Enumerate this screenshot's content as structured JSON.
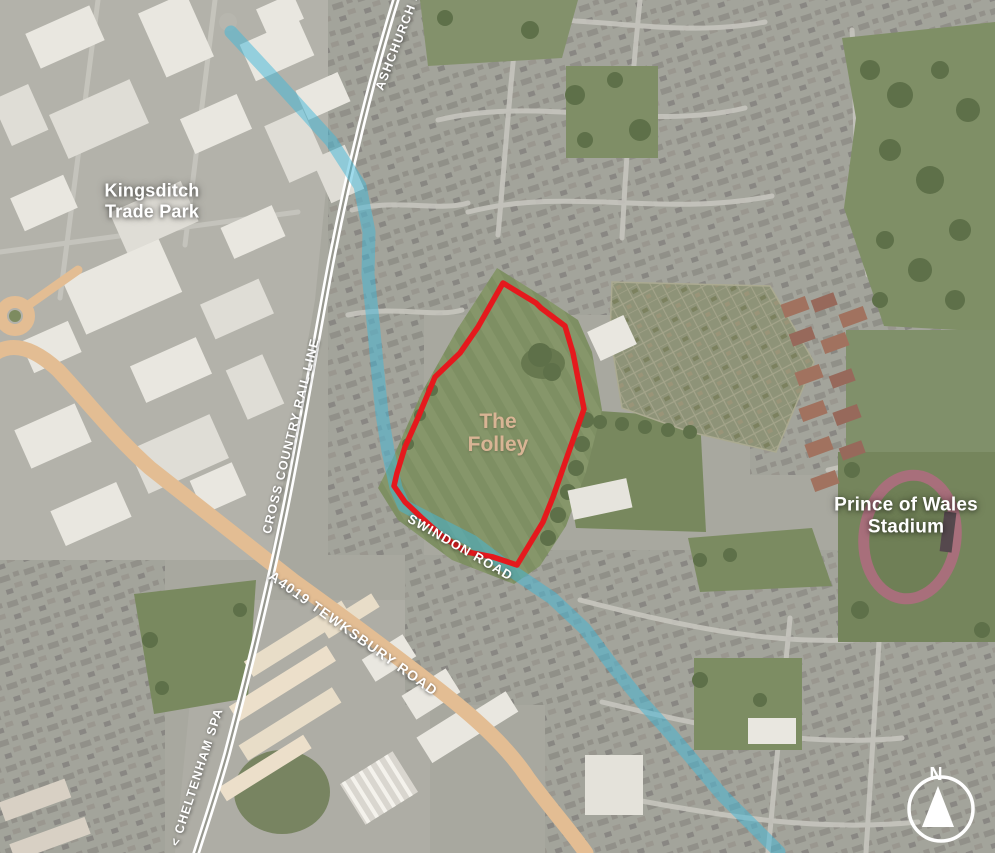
{
  "labels": {
    "trade_park_line1": "Kingsditch",
    "trade_park_line2": "Trade Park",
    "site_line1": "The",
    "site_line2": "Folley",
    "stadium_line1": "Prince of Wales",
    "stadium_line2": "Stadium",
    "rail_name": "CROSS COUNTRY RAIL LINE",
    "rail_north_destination": "ASHCHURCH >",
    "rail_south_destination": "< CHELTENHAM SPA",
    "swindon_road": "SWINDON ROAD",
    "tewksbury_road": "A4019 TEWKSBURY ROAD",
    "compass_north": "N"
  },
  "colors": {
    "site_boundary": "#e5191d",
    "route_highlight": "#3fb7da",
    "a4019_road": "#e3bd93",
    "site_label": "#d8b494",
    "map_label": "#ffffff"
  }
}
